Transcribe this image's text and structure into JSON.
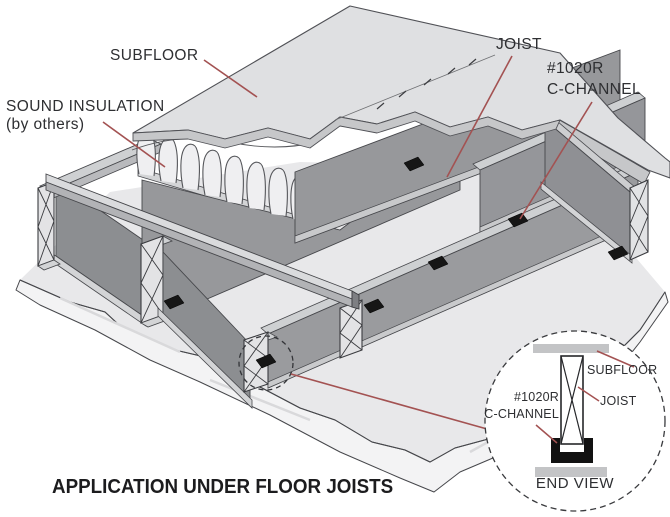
{
  "diagram": {
    "caption": "APPLICATION UNDER FLOOR JOISTS",
    "labels": {
      "subfloor": "SUBFLOOR",
      "sound_insulation": "SOUND INSULATION",
      "sound_insulation_note": "(by others)",
      "joist": "JOIST",
      "c_channel_model": "#1020R",
      "c_channel_name": "C-CHANNEL"
    },
    "detail_view": {
      "subfloor": "SUBFLOOR",
      "joist": "JOIST",
      "c_channel_model": "#1020R",
      "c_channel_name": "C-CHANNEL",
      "caption": "END VIEW"
    },
    "colors": {
      "leader_line": "#a35252",
      "clip_black": "#161616",
      "joist_face_gray": "#97989b",
      "rim_face_gray": "#8c8e91",
      "slab_gray": "#e8e8ea",
      "subfloor_sheet_gray": "#dfe0e2",
      "sheet_edge_band": "#c6c7c9",
      "outline": "#46474b"
    }
  }
}
